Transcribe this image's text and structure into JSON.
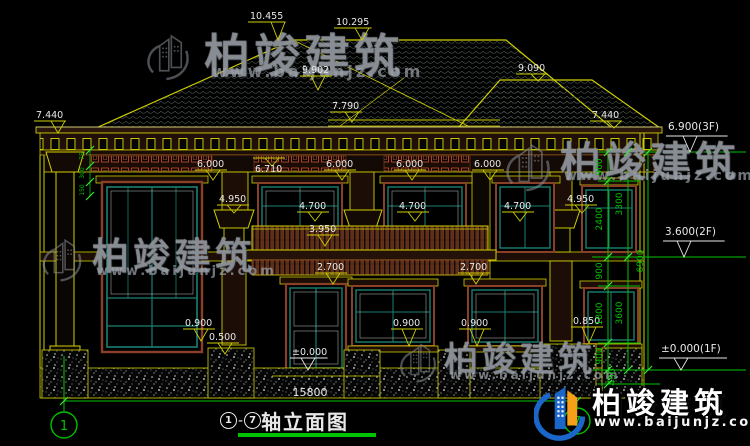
{
  "page": {
    "width": 750,
    "height": 446,
    "background": "#000000"
  },
  "drawing": {
    "title": {
      "left_axis": "1",
      "separator": "-",
      "right_axis": "7",
      "name": "轴立面图",
      "full": "①-⑦轴立面图"
    },
    "grid_bubbles": [
      {
        "label": "1"
      },
      {
        "label": "7"
      }
    ],
    "overall_width_dim": "15800",
    "elevation_markers": [
      {
        "v": "10.455",
        "tx": 250,
        "ty": 10,
        "ly": 22,
        "px": 278,
        "py": 40,
        "c": "y"
      },
      {
        "v": "10.295",
        "tx": 336,
        "ty": 16,
        "ly": 28,
        "px": 362,
        "py": 40,
        "c": "y"
      },
      {
        "v": "9.902",
        "tx": 302,
        "ty": 64,
        "ly": 76,
        "px": 318,
        "py": 90,
        "c": "y"
      },
      {
        "v": "7.790",
        "tx": 332,
        "ty": 100,
        "ly": 112,
        "px": 352,
        "py": 122,
        "c": "y"
      },
      {
        "v": "9.090",
        "tx": 518,
        "ty": 62,
        "ly": 74,
        "px": 538,
        "py": 81,
        "c": "y"
      },
      {
        "v": "7.440",
        "tx": 36,
        "ty": 109,
        "ly": 121,
        "px": 58,
        "py": 133,
        "c": "y"
      },
      {
        "v": "7.440",
        "tx": 592,
        "ty": 109,
        "ly": 121,
        "px": 614,
        "py": 128,
        "c": "y"
      },
      {
        "v": "6.000",
        "tx": 197,
        "ty": 158,
        "ly": 170,
        "px": 213,
        "py": 180,
        "c": "y"
      },
      {
        "v": "6.710",
        "tx": 255,
        "ty": 163,
        "ly": 158,
        "px": 272,
        "py": 166,
        "c": "y"
      },
      {
        "v": "6.000",
        "tx": 326,
        "ty": 158,
        "ly": 170,
        "px": 342,
        "py": 180,
        "c": "y"
      },
      {
        "v": "6.000",
        "tx": 396,
        "ty": 158,
        "ly": 170,
        "px": 412,
        "py": 180,
        "c": "y"
      },
      {
        "v": "6.000",
        "tx": 474,
        "ty": 158,
        "ly": 170,
        "px": 490,
        "py": 180,
        "c": "y"
      },
      {
        "v": "4.950",
        "tx": 219,
        "ty": 193,
        "ly": 205,
        "px": 234,
        "py": 213,
        "c": "y"
      },
      {
        "v": "4.950",
        "tx": 567,
        "ty": 193,
        "ly": 205,
        "px": 582,
        "py": 213,
        "c": "y"
      },
      {
        "v": "4.700",
        "tx": 299,
        "ty": 200,
        "ly": 212,
        "px": 315,
        "py": 221,
        "c": "y"
      },
      {
        "v": "4.700",
        "tx": 399,
        "ty": 200,
        "ly": 212,
        "px": 415,
        "py": 221,
        "c": "y"
      },
      {
        "v": "4.700",
        "tx": 504,
        "ty": 200,
        "ly": 212,
        "px": 520,
        "py": 221,
        "c": "y"
      },
      {
        "v": "3.950",
        "tx": 309,
        "ty": 223,
        "ly": 235,
        "px": 325,
        "py": 246,
        "c": "y"
      },
      {
        "v": "2.700",
        "tx": 317,
        "ty": 261,
        "ly": 273,
        "px": 333,
        "py": 284,
        "c": "y"
      },
      {
        "v": "2.700",
        "tx": 460,
        "ty": 261,
        "ly": 273,
        "px": 476,
        "py": 284,
        "c": "y"
      },
      {
        "v": "0.900",
        "tx": 185,
        "ty": 317,
        "ly": 329,
        "px": 201,
        "py": 341,
        "c": "y"
      },
      {
        "v": "0.900",
        "tx": 393,
        "ty": 317,
        "ly": 329,
        "px": 409,
        "py": 346,
        "c": "y"
      },
      {
        "v": "0.900",
        "tx": 461,
        "ty": 317,
        "ly": 329,
        "px": 477,
        "py": 346,
        "c": "y"
      },
      {
        "v": "0.500",
        "tx": 209,
        "ty": 331,
        "ly": 343,
        "px": 225,
        "py": 354,
        "c": "y"
      },
      {
        "v": "0.850",
        "tx": 573,
        "ty": 315,
        "ly": 327,
        "px": 589,
        "py": 343,
        "c": "y"
      },
      {
        "v": "±0.000",
        "tx": 292,
        "ty": 346,
        "ly": 358,
        "px": 308,
        "py": 370,
        "c": "w"
      }
    ],
    "level_markers": [
      {
        "v": "6.900(3F)",
        "tx": 668,
        "ty": 121,
        "ly": 136,
        "px": 690,
        "py": 152,
        "c": "w"
      },
      {
        "v": "3.600(2F)",
        "tx": 665,
        "ty": 226,
        "ly": 241,
        "px": 684,
        "py": 257,
        "c": "w"
      },
      {
        "v": "±0.000(1F)",
        "tx": 661,
        "ty": 343,
        "ly": 358,
        "px": 681,
        "py": 370,
        "c": "w"
      }
    ],
    "chain_dims": [
      {
        "v": "900",
        "x": 602,
        "y": 167
      },
      {
        "v": "2400",
        "x": 602,
        "y": 219
      },
      {
        "v": "900",
        "x": 602,
        "y": 271
      },
      {
        "v": "1800",
        "x": 602,
        "y": 314
      },
      {
        "v": "900",
        "x": 602,
        "y": 356
      },
      {
        "v": "450",
        "x": 615,
        "y": 377
      },
      {
        "v": "3300",
        "x": 622,
        "y": 204
      },
      {
        "v": "3600",
        "x": 622,
        "y": 313
      },
      {
        "v": "6900",
        "x": 643,
        "y": 261
      }
    ],
    "detail_dims": [
      {
        "v": "75",
        "x": 84,
        "y": 156
      },
      {
        "v": "300",
        "x": 84,
        "y": 173
      },
      {
        "v": "150",
        "x": 84,
        "y": 190
      }
    ]
  },
  "watermarks": [
    {
      "text": "柏竣建筑",
      "url": "www.baijunjz.com"
    },
    {
      "text": "柏竣建筑",
      "url": "www.baijunjz.com"
    },
    {
      "text": "柏竣建筑",
      "url": "www.baijunjz.com"
    },
    {
      "text": "柏竣建筑",
      "url": "www.baijunjz.com"
    }
  ],
  "logo": {
    "text": "柏竣建筑",
    "url": "www.baijunjz.com"
  },
  "colors": {
    "line_yellow": "#cfcf00",
    "line_green": "#00c400",
    "tick_green": "#39e639",
    "text_white": "#e8e8e8",
    "frame_teal": "#1b7f72",
    "casing_brown": "#8a4028",
    "accent_red": "#c8502e",
    "logo_blue": "#1b66c9",
    "logo_orange": "#f6a01a"
  }
}
